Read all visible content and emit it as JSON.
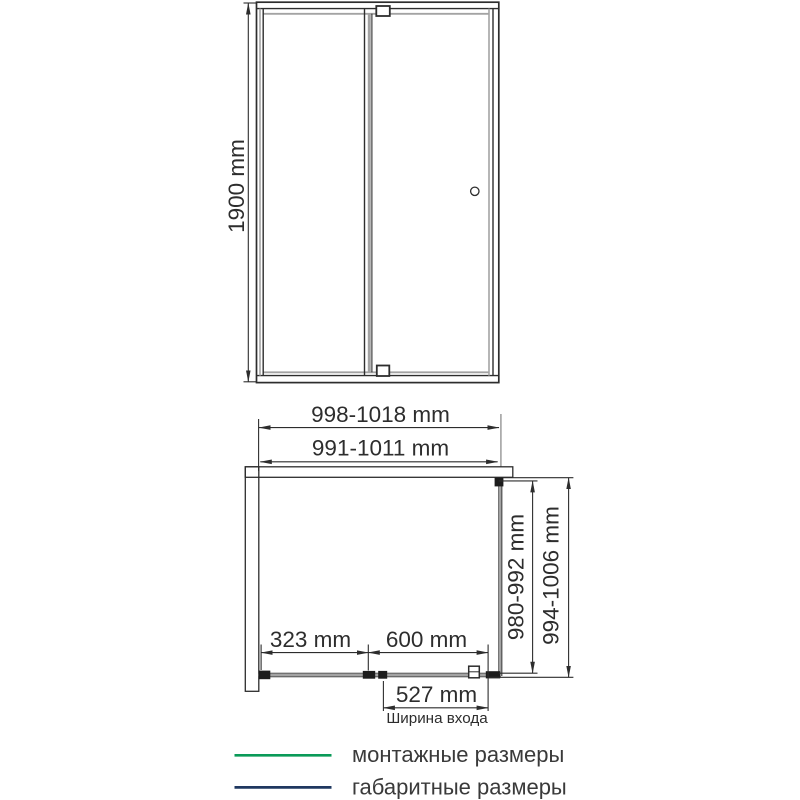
{
  "colors": {
    "mounting_green": "#0a9a58",
    "overall_navy": "#1f3860",
    "line_dark": "#2d2d2d",
    "glass_gray": "#a3a3a3"
  },
  "front_view": {
    "height_dim": "1900 mm"
  },
  "plan_view": {
    "overall_width_dim": "998-1018 mm",
    "mounting_width_dim": "991-1011 mm",
    "mounting_depth_dim": "980-992 mm",
    "overall_depth_dim": "994-1006 mm",
    "fixed_panel_dim": "323 mm",
    "door_dim": "600 mm",
    "entrance_dim": "527 mm",
    "entrance_caption": "Ширина входа"
  },
  "legend": {
    "mounting_label": "монтажные размеры",
    "overall_label": "габаритные размеры"
  }
}
